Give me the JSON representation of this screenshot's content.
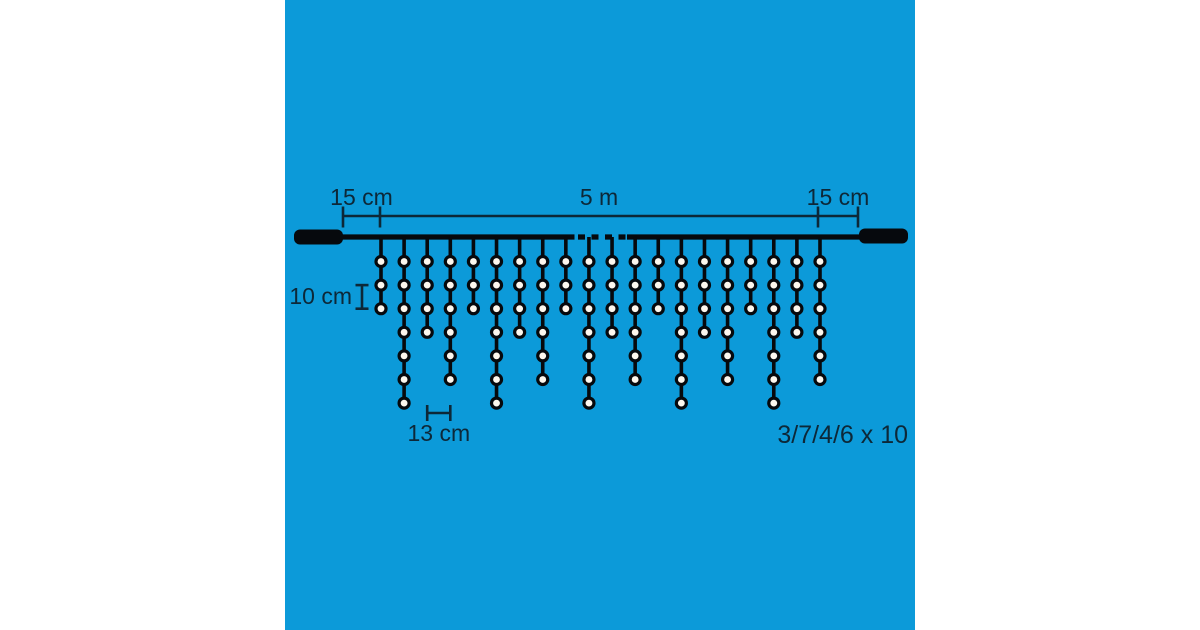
{
  "diagram": {
    "labels": {
      "left_margin": "15 cm",
      "total_length": "5 m",
      "right_margin": "15 cm",
      "vertical_bulb_spacing": "10 cm",
      "horizontal_drop_spacing": "13 cm",
      "drop_pattern": "3/7/4/6 x 10"
    },
    "drops": {
      "pattern_bulbs_per_drop": [
        3,
        7,
        4,
        6
      ],
      "visible_drops_bulb_counts": [
        3,
        7,
        4,
        6,
        3,
        7,
        4,
        6,
        3,
        7,
        4,
        6,
        3,
        7,
        4,
        6,
        3,
        7,
        4,
        6
      ]
    },
    "colors": {
      "background_blue": "#0C9AD9",
      "page_white": "#FFFFFF",
      "wire_black": "#06090D",
      "annotation_ink": "#0D2838",
      "bulb_fill": "#FCF7EE"
    }
  }
}
